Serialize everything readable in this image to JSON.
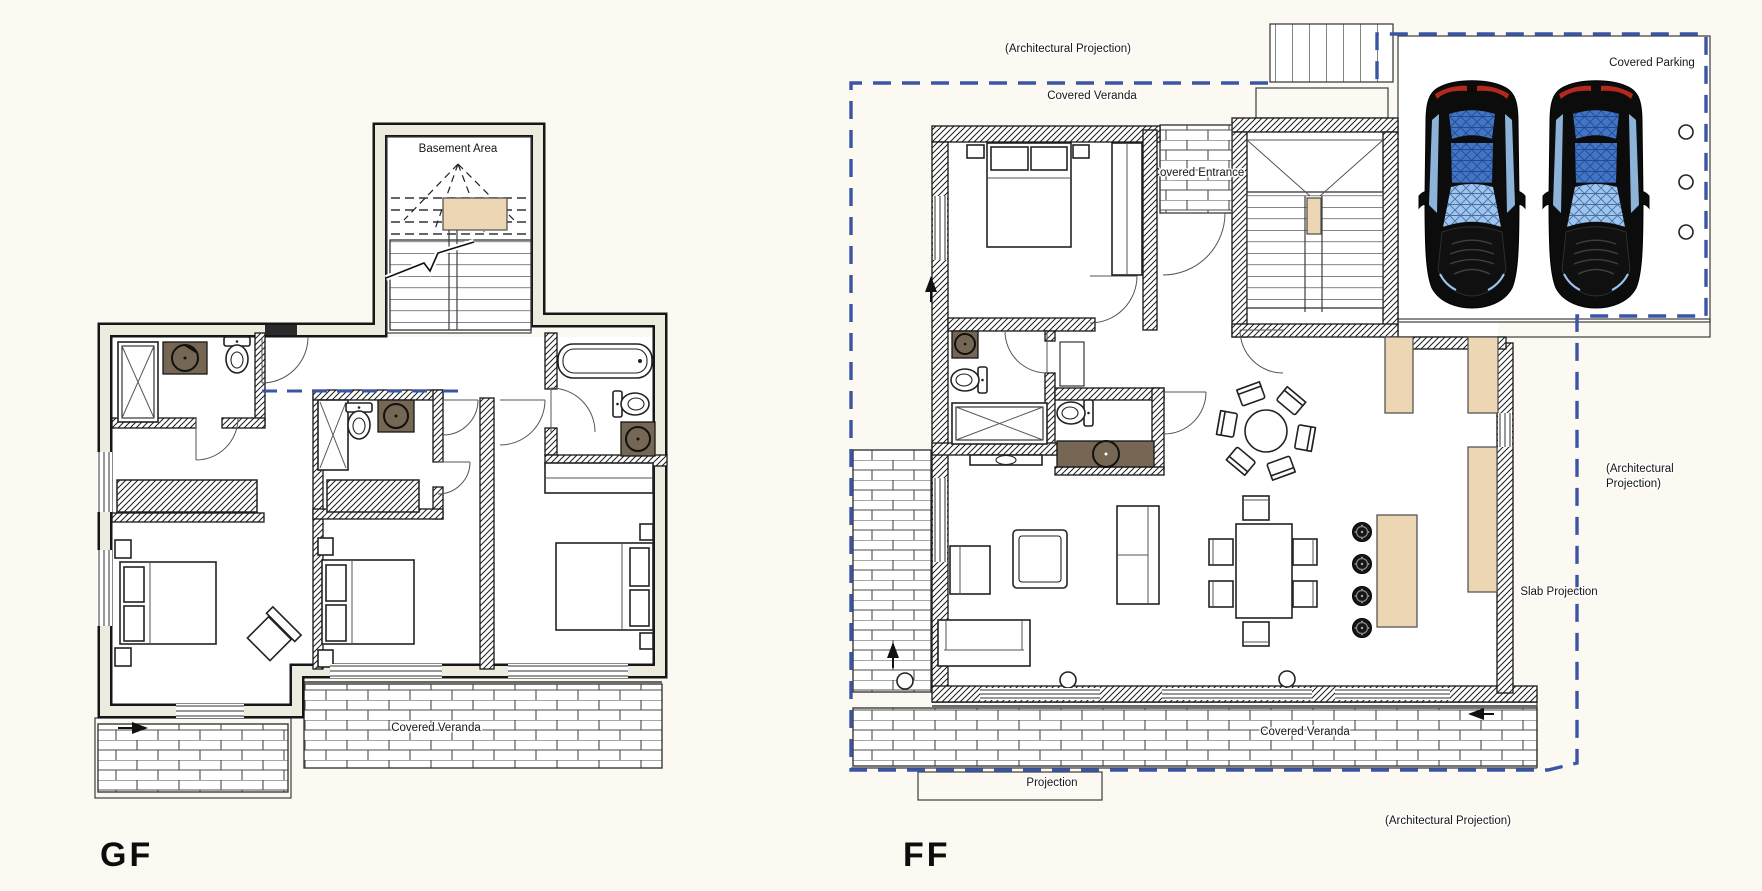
{
  "document": {
    "kind": "architectural floor plan drawing",
    "sheet_background": "#fbf9f2"
  },
  "colors": {
    "paper": "#fbf9f2",
    "ink": "#161616",
    "projection_blue": "#3a55a6",
    "tan": "#ecd6b4",
    "appliance_brown": "#756753",
    "car_body": "#0c0c0c",
    "car_glass_light": "#9cc5f0",
    "car_glass_mid": "#4075c8",
    "taillight_red": "#b5281c"
  },
  "plans": {
    "gf": {
      "floor_label": "GF",
      "labels": {
        "basement_area": "Basement Area",
        "covered_veranda": "Covered Veranda"
      }
    },
    "ff": {
      "floor_label": "FF",
      "labels": {
        "architectural_projection_top": "(Architectural Projection)",
        "covered_veranda_top": "Covered Veranda",
        "covered_parking": "Covered Parking",
        "covered_entrance": "Covered Entrance",
        "architectural_projection_right_line1": "(Architectural",
        "architectural_projection_right_line2": "Projection)",
        "slab_projection": "Slab Projection",
        "covered_veranda_bottom": "Covered Veranda",
        "projection_steps": "Projection",
        "architectural_projection_bottom": "(Architectural Projection)"
      }
    }
  }
}
